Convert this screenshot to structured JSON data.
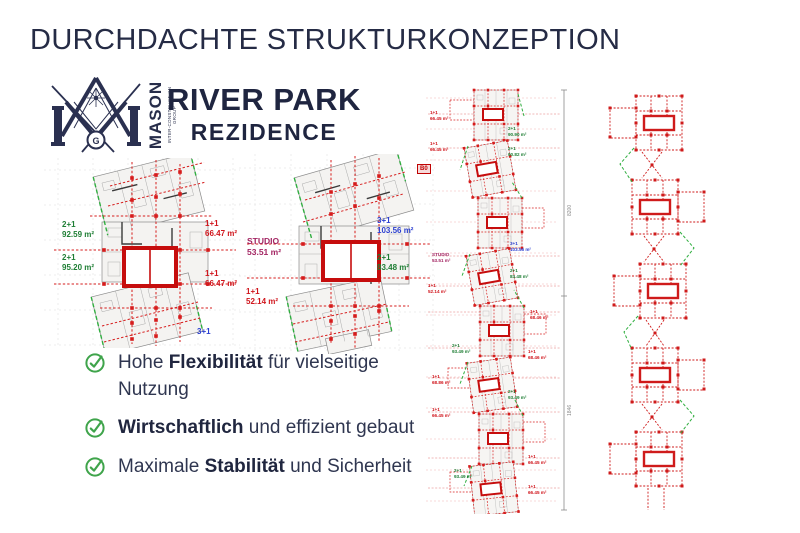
{
  "slide": {
    "title": "DURCHDACHTE STRUKTURKONZEPTION"
  },
  "logo": {
    "brand": "MASON",
    "brand_sub": "INTER-CONSTRUCTION GROUP",
    "g": "G",
    "project": "RIVER PARK",
    "project_sub": "REZIDENCE"
  },
  "bullets": [
    {
      "pre": "Hohe ",
      "bold": "Flexibilität",
      "post": " für vielseitige Nutzung"
    },
    {
      "pre": "",
      "bold": "Wirtschaftlich",
      "post": " und effizient gebaut"
    },
    {
      "pre": "Maximale ",
      "bold": "Stabilität",
      "post": " und Sicherheit"
    }
  ],
  "plan_a": {
    "labels": [
      "2+1\n92.59 m²",
      "2+1\n95.20 m²",
      "1+1\n66.47 m²",
      "1+1\n66.47 m²",
      "3+1"
    ]
  },
  "plan_b": {
    "badge": "B0",
    "labels": [
      "STUDIO\n53.51 m²",
      "3+1\n103.56 m²",
      "2+1\n83.48 m²",
      "1+1\n52.14 m²"
    ]
  },
  "strip_mid": {
    "dim_top": "8200",
    "dim_bottom": "1846",
    "labels": [
      "1+1\n66.45 m²",
      "2+1\n90.90 m²",
      "1+1\n66.45 m²",
      "2+1\n90.82 m²",
      "3+1\n103.56 m²",
      "STUDIO\n53.51 m²",
      "2+1\n83.48 m²",
      "1+1\n52.14 m²",
      "1+1\n68.46 m²",
      "2+1\n93.49 m²",
      "1+1\n68.46 m²",
      "1+1\n68.86 m²",
      "2+1\n93.49 m²",
      "1+1\n66.45 m²",
      "1+1\n66.45 m²",
      "2+1\n93.49 m²",
      "1+1\n66.45 m²"
    ]
  },
  "colors": {
    "navy": "#252b45",
    "red": "#d61c1c",
    "green": "#1e7e34",
    "blue": "#2b3fd0",
    "magenta": "#a32462",
    "check_green": "#3fa44b"
  }
}
